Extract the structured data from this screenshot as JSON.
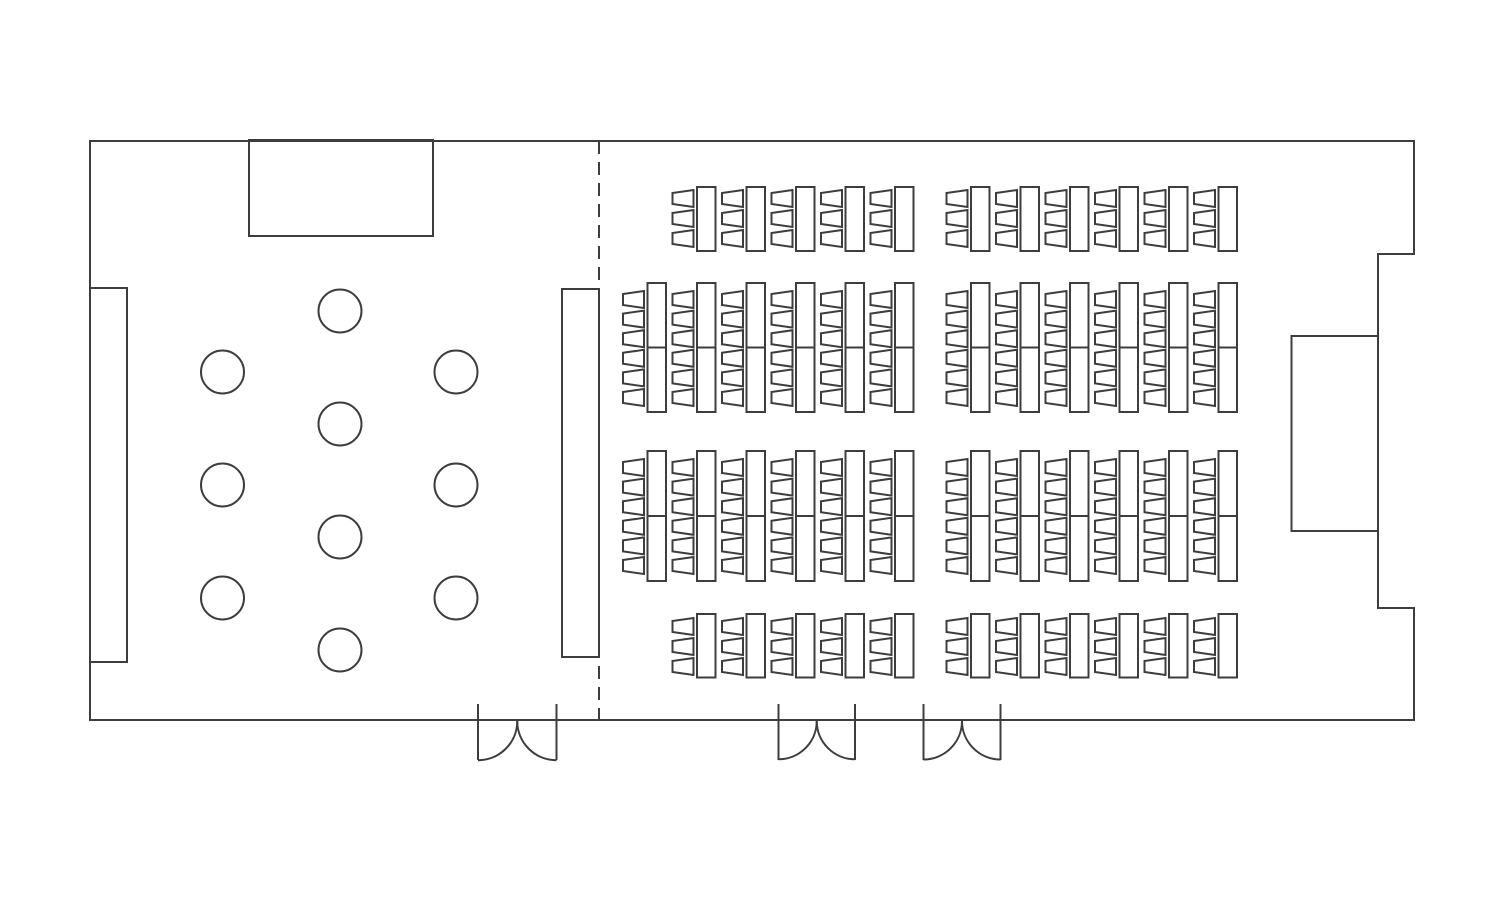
{
  "canvas": {
    "width": 1500,
    "height": 900
  },
  "style": {
    "line_color": "#3d3d3d",
    "background": "#ffffff",
    "stroke_width": 2
  },
  "floor_plan": {
    "room": {
      "outline_points": [
        [
          90,
          141
        ],
        [
          1414,
          141
        ],
        [
          1414,
          254
        ],
        [
          1378,
          254
        ],
        [
          1378,
          608
        ],
        [
          1414,
          608
        ],
        [
          1414,
          720
        ],
        [
          90,
          720
        ]
      ]
    },
    "stage": {
      "x": 249,
      "y": 140,
      "width": 184,
      "height": 96
    },
    "counters": [
      {
        "id": "left-wall-counter",
        "x": 90,
        "y": 288,
        "width": 37,
        "height": 374
      },
      {
        "id": "divider-counter",
        "x": 562,
        "y": 289,
        "width": 37,
        "height": 368
      },
      {
        "id": "right-wall-alcove",
        "x": 1291.5,
        "y": 336,
        "width": 86.5,
        "height": 195
      }
    ],
    "divider": {
      "x": 599,
      "y1": 141,
      "y2": 720,
      "dash": [
        13,
        8
      ]
    },
    "cocktail_tables": {
      "radius": 21.5,
      "centers": [
        [
          340,
          311
        ],
        [
          340,
          424
        ],
        [
          340,
          537
        ],
        [
          340,
          650
        ],
        [
          222.5,
          372
        ],
        [
          222.5,
          485
        ],
        [
          222.5,
          598
        ],
        [
          456,
          372
        ],
        [
          456,
          485
        ],
        [
          456,
          598
        ]
      ]
    },
    "seating": {
      "unit": {
        "pitch": 49.5,
        "chair_width": 21,
        "chair_height": 17,
        "chair_back_taper": 3,
        "table_offset_x": 24.5,
        "table_width": 18.5
      },
      "bands": [
        {
          "name": "row-1",
          "table_y": 187,
          "table_height": 64,
          "chair_start_y": 190,
          "chairs_per_table": 3,
          "chair_pitch": 20,
          "groups": [
            {
              "start_x": 672.5,
              "units": 5
            },
            {
              "start_x": 946.5,
              "units": 6
            }
          ]
        },
        {
          "name": "row-2",
          "table_y": 283,
          "table_height": 129,
          "table_split_y": 347.5,
          "chair_start_y": 291,
          "chairs_per_table": 6,
          "chair_pitch": 19.6,
          "groups": [
            {
              "start_x": 623,
              "units": 6
            },
            {
              "start_x": 946.5,
              "units": 6
            }
          ]
        },
        {
          "name": "row-3",
          "table_y": 451,
          "table_height": 130,
          "table_split_y": 516,
          "chair_start_y": 459,
          "chairs_per_table": 6,
          "chair_pitch": 19.6,
          "groups": [
            {
              "start_x": 623,
              "units": 6
            },
            {
              "start_x": 946.5,
              "units": 6
            }
          ]
        },
        {
          "name": "row-4",
          "table_y": 614,
          "table_height": 63.5,
          "chair_start_y": 618,
          "chairs_per_table": 3,
          "chair_pitch": 20,
          "groups": [
            {
              "start_x": 672.5,
              "units": 5
            },
            {
              "start_x": 946.5,
              "units": 6
            }
          ]
        }
      ]
    },
    "doors": {
      "pivot_y": 721,
      "jamb_top_y": 704,
      "jamb_bottom_y": 760,
      "items": [
        {
          "x_left": 478,
          "x_right": 556.5
        },
        {
          "x_left": 778.5,
          "x_right": 855
        },
        {
          "x_left": 923.5,
          "x_right": 1000.5
        }
      ]
    }
  }
}
